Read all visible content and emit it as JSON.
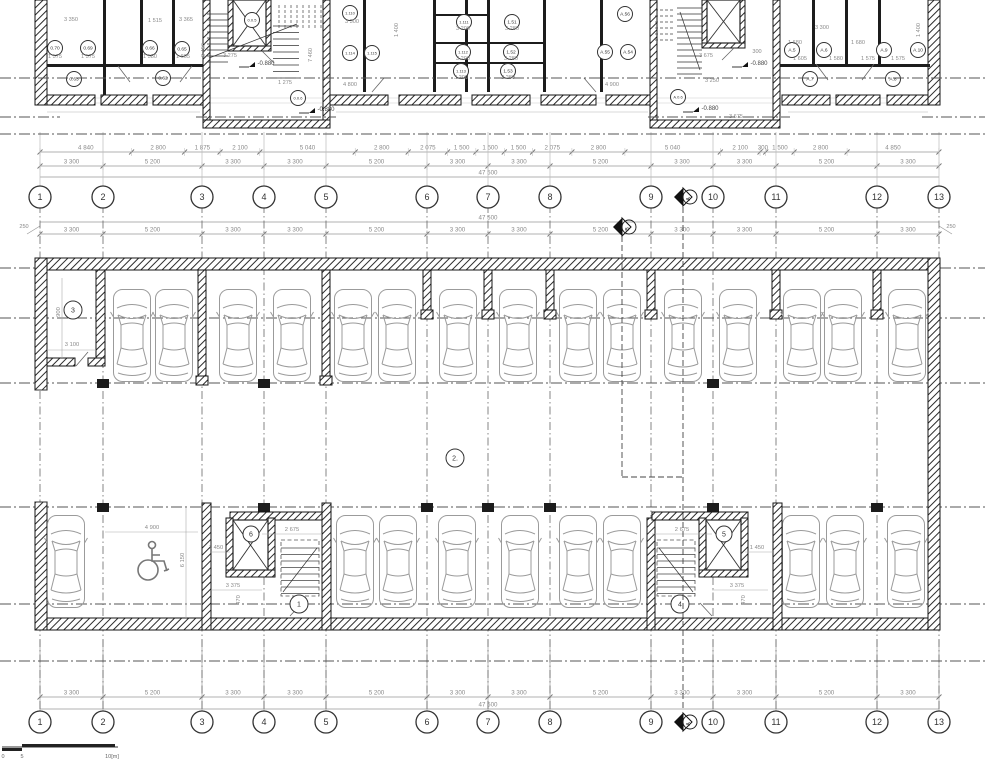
{
  "drawing": {
    "grid": {
      "labels": [
        "1",
        "2",
        "3",
        "4",
        "5",
        "6",
        "7",
        "8",
        "9",
        "10",
        "11",
        "12",
        "13"
      ],
      "x": [
        40,
        103,
        202,
        264,
        326,
        427,
        488,
        550,
        651,
        713,
        776,
        877,
        939
      ],
      "mid_bubble_y": 197,
      "bottom_bubble_y": 722
    },
    "section_markers": [
      {
        "label": "A",
        "x": 683,
        "y": 197
      },
      {
        "label": "B",
        "x": 622,
        "y": 227
      },
      {
        "label": "A",
        "x": 683,
        "y": 722
      }
    ],
    "dims": {
      "row_a": {
        "y": 152,
        "values": [
          "4 840",
          "2 800",
          "1 875",
          "2 100",
          "5 040",
          "2 800",
          "2 075",
          "1 500",
          "1 500",
          "1 500",
          "2 075",
          "2 800",
          "5 040",
          "2 100",
          "300",
          "1 500",
          "2 800",
          "4 850"
        ],
        "mm": [
          4840,
          2800,
          1875,
          2100,
          5040,
          2800,
          2075,
          1500,
          1500,
          1500,
          2075,
          2800,
          5040,
          2100,
          300,
          1500,
          2800,
          4850
        ]
      },
      "row_b": {
        "y": 166,
        "values": [
          "3 300",
          "5 200",
          "3 300",
          "3 300",
          "5 200",
          "3 300",
          "3 300",
          "5 200",
          "3 300",
          "3 300",
          "5 200",
          "3 300"
        ]
      },
      "total_mid": {
        "y": 177,
        "label": "47 500"
      },
      "parking_top": {
        "y": 234,
        "total_y": 222,
        "total": "47 500",
        "side_left": "250",
        "side_right": "250",
        "values": [
          "3 300",
          "5 200",
          "3 300",
          "3 300",
          "5 200",
          "3 300",
          "3 300",
          "5 200",
          "3 300",
          "3 300",
          "5 200",
          "3 300"
        ]
      },
      "bottom": {
        "y": 697,
        "total_y": 709,
        "total": "47 500",
        "values": [
          "3 300",
          "5 200",
          "3 300",
          "3 300",
          "5 200",
          "3 300",
          "3 300",
          "5 200",
          "3 300",
          "3 300",
          "5 200",
          "3 300"
        ]
      }
    },
    "upper_plan": {
      "room_labels": [
        {
          "t": "0.70",
          "x": 55,
          "y": 48
        },
        {
          "t": "0.69",
          "x": 88,
          "y": 48
        },
        {
          "t": "0.66",
          "x": 150,
          "y": 48
        },
        {
          "t": "0.65",
          "x": 182,
          "y": 49
        },
        {
          "t": "0.63",
          "x": 74,
          "y": 79
        },
        {
          "t": "0.62",
          "x": 163,
          "y": 78
        },
        {
          "t": "0.0.5",
          "x": 252,
          "y": 20
        },
        {
          "t": "0.0.6",
          "x": 298,
          "y": 98
        },
        {
          "t": "1.110",
          "x": 350,
          "y": 13
        },
        {
          "t": "1.114",
          "x": 350,
          "y": 53
        },
        {
          "t": "1.115",
          "x": 372,
          "y": 53
        },
        {
          "t": "1.111",
          "x": 464,
          "y": 22
        },
        {
          "t": "1.112",
          "x": 463,
          "y": 52
        },
        {
          "t": "1.113",
          "x": 461,
          "y": 71
        },
        {
          "t": "1.51",
          "x": 512,
          "y": 22
        },
        {
          "t": "1.52",
          "x": 511,
          "y": 52
        },
        {
          "t": "1.53",
          "x": 508,
          "y": 71
        },
        {
          "t": "A.56",
          "x": 625,
          "y": 14
        },
        {
          "t": "A.55",
          "x": 605,
          "y": 52
        },
        {
          "t": "A.54",
          "x": 628,
          "y": 52
        },
        {
          "t": "A.0.6",
          "x": 678,
          "y": 97
        },
        {
          "t": "A.5",
          "x": 792,
          "y": 50
        },
        {
          "t": "A.6",
          "x": 824,
          "y": 50
        },
        {
          "t": "A.7",
          "x": 810,
          "y": 79
        },
        {
          "t": "A.9",
          "x": 884,
          "y": 50
        },
        {
          "t": "A.10",
          "x": 918,
          "y": 50
        },
        {
          "t": "A.8",
          "x": 893,
          "y": 79
        }
      ],
      "level_marks": [
        {
          "t": "-0.880",
          "x": 248,
          "y": 67
        },
        {
          "t": "-0.880",
          "x": 308,
          "y": 113
        },
        {
          "t": "-0.880",
          "x": 741,
          "y": 67
        },
        {
          "t": "-0.880",
          "x": 692,
          "y": 112
        }
      ],
      "dim_texts": [
        {
          "t": "3 350",
          "x": 71,
          "y": 21
        },
        {
          "t": "1 515",
          "x": 155,
          "y": 22
        },
        {
          "t": "3 365",
          "x": 186,
          "y": 21
        },
        {
          "t": "1 575",
          "x": 55,
          "y": 58
        },
        {
          "t": "1 575",
          "x": 88,
          "y": 58
        },
        {
          "t": "1 580",
          "x": 150,
          "y": 58
        },
        {
          "t": "1 605",
          "x": 183,
          "y": 58
        },
        {
          "t": "3 275",
          "x": 230,
          "y": 57
        },
        {
          "t": "1 275",
          "x": 285,
          "y": 84
        },
        {
          "t": "3 456",
          "x": 205,
          "y": 50,
          "r": 1
        },
        {
          "t": "7 460",
          "x": 312,
          "y": 55,
          "r": 1
        },
        {
          "t": "3 675",
          "x": 706,
          "y": 57
        },
        {
          "t": "3 675",
          "x": 736,
          "y": 118
        },
        {
          "t": "300",
          "x": 757,
          "y": 53
        },
        {
          "t": "3 300",
          "x": 352,
          "y": 23
        },
        {
          "t": "3 200",
          "x": 463,
          "y": 30
        },
        {
          "t": "3 200",
          "x": 463,
          "y": 60
        },
        {
          "t": "3 200",
          "x": 461,
          "y": 79
        },
        {
          "t": "3 280",
          "x": 512,
          "y": 30
        },
        {
          "t": "3 280",
          "x": 511,
          "y": 60
        },
        {
          "t": "3 280",
          "x": 508,
          "y": 79
        },
        {
          "t": "4 800",
          "x": 350,
          "y": 86
        },
        {
          "t": "4 900",
          "x": 612,
          "y": 86
        },
        {
          "t": "3 300",
          "x": 822,
          "y": 29
        },
        {
          "t": "1 680",
          "x": 795,
          "y": 44
        },
        {
          "t": "1 680",
          "x": 858,
          "y": 44
        },
        {
          "t": "3 250",
          "x": 712,
          "y": 82
        },
        {
          "t": "1 605",
          "x": 800,
          "y": 60
        },
        {
          "t": "1 580",
          "x": 836,
          "y": 60
        },
        {
          "t": "1 575",
          "x": 868,
          "y": 60
        },
        {
          "t": "1 575",
          "x": 898,
          "y": 60
        },
        {
          "t": "1 400",
          "x": 920,
          "y": 30,
          "r": 1
        },
        {
          "t": "1 400",
          "x": 398,
          "y": 30,
          "r": 1
        }
      ]
    },
    "parking": {
      "space_labels": [
        {
          "t": "3",
          "x": 73,
          "y": 310,
          "r": 9
        },
        {
          "t": "2.",
          "x": 455,
          "y": 458,
          "r": 9
        },
        {
          "t": "6",
          "x": 251,
          "y": 534,
          "r": 8
        },
        {
          "t": "1",
          "x": 299,
          "y": 604,
          "r": 9
        },
        {
          "t": "5",
          "x": 724,
          "y": 534,
          "r": 8
        },
        {
          "t": "4",
          "x": 680,
          "y": 604,
          "r": 9
        }
      ],
      "dim_texts": [
        {
          "t": "900",
          "x": 60,
          "y": 312,
          "r": 1
        },
        {
          "t": "3 100",
          "x": 72,
          "y": 346
        },
        {
          "t": "4 900",
          "x": 152,
          "y": 529
        },
        {
          "t": "6 150",
          "x": 184,
          "y": 560,
          "r": 1
        },
        {
          "t": "1 450",
          "x": 216,
          "y": 549
        },
        {
          "t": "2 675",
          "x": 292,
          "y": 531
        },
        {
          "t": "3 375",
          "x": 233,
          "y": 587
        },
        {
          "t": "470",
          "x": 240,
          "y": 600,
          "r": 1
        },
        {
          "t": "2 675",
          "x": 682,
          "y": 531
        },
        {
          "t": "1 450",
          "x": 757,
          "y": 549
        },
        {
          "t": "3 375",
          "x": 737,
          "y": 587
        },
        {
          "t": "470",
          "x": 745,
          "y": 600,
          "r": 1
        }
      ],
      "cars_top_x": [
        132,
        174,
        238,
        292,
        353,
        397,
        458,
        518,
        578,
        622,
        683,
        738,
        802,
        843,
        907
      ],
      "cars_top_y": 288,
      "cars_bottom_x": [
        66,
        355,
        398,
        457,
        520,
        578,
        622,
        801,
        845,
        906
      ],
      "cars_bottom_y": 514,
      "car_w": 40,
      "car_len": 95
    },
    "scale_bar": {
      "labels": [
        "0",
        "5",
        "10[m]"
      ]
    },
    "colors": {
      "wall": "#1a1a1a",
      "dim": "#8a8a8a",
      "dashdot": "#555555",
      "car": "#9b9b9b",
      "text": "#333333"
    }
  }
}
